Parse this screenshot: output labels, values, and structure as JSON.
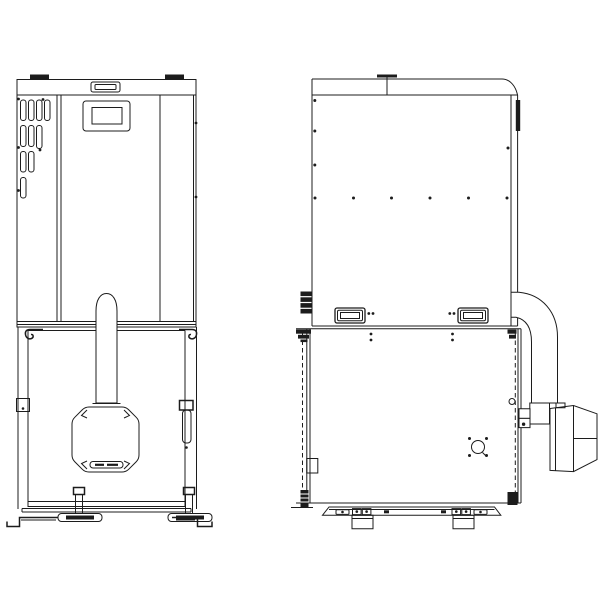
{
  "page": {
    "background_color": "#ffffff"
  },
  "drawing": {
    "kind": "technical-line-drawing",
    "line_color": "#1c1c1c",
    "views": [
      {
        "name": "front-view",
        "parts": [
          "lift-tab",
          "top-cap-handle",
          "control-display",
          "vent-grille",
          "cabinet-door-seams",
          "flue-pipe",
          "burner-door-octagon",
          "burner-grille",
          "door-latch",
          "hinge-clips",
          "base-beam",
          "leveling-feet",
          "floor-brackets"
        ]
      },
      {
        "name": "side-view",
        "parts": [
          "lid-handle",
          "hinge-bar",
          "screw-dots",
          "cable-glands",
          "carry-handles",
          "body-seam",
          "door-hinges",
          "door-latch-plate",
          "inspection-port",
          "pellet-feed-tube",
          "feed-coupler",
          "auger-motor",
          "base-rail",
          "support-feet"
        ]
      }
    ]
  }
}
